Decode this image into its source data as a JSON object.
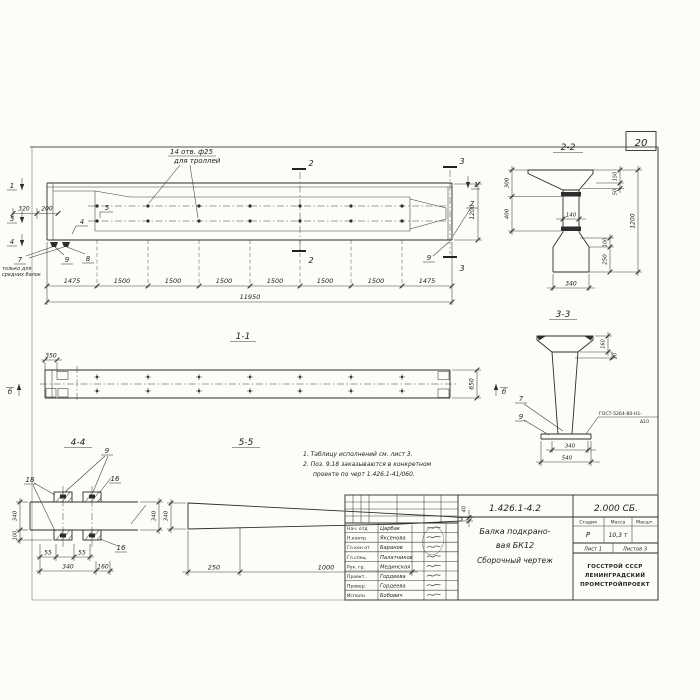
{
  "page": {
    "number": "20"
  },
  "el": {
    "callout1": "14 отв. ф25",
    "callout2": "для троллей",
    "d320": "320",
    "d200": "200",
    "d1200": "1200",
    "p5": "5",
    "p4": "4",
    "p7l": "7",
    "p9l": "9",
    "p8": "8",
    "p7r": "7",
    "p9r": "9",
    "note1": "только для",
    "note2": "средних балок",
    "m1l": "1",
    "m5": "5",
    "m4": "4",
    "m1r": "1",
    "m2": "2",
    "m3": "3",
    "chain": [
      "1475",
      "1500",
      "1500",
      "1500",
      "1500",
      "1500",
      "1500",
      "1475"
    ],
    "total": "11950"
  },
  "s22": {
    "title": "2-2",
    "d300": "300",
    "d400": "400",
    "d140": "140",
    "d150": "150",
    "d50": "50",
    "d1200": "1200",
    "d100": "100",
    "d250": "250",
    "d340": "340"
  },
  "s33": {
    "title": "3-3",
    "d160": "160",
    "d30": "30",
    "d340": "340",
    "d540": "540",
    "p7": "7",
    "p9": "9",
    "weld1": "ГОСТ-5264-80-Н1-",
    "weld2": "Δ10"
  },
  "s11": {
    "title": "1-1",
    "d350": "350",
    "d650": "650",
    "mark": "б"
  },
  "s44": {
    "title": "4-4",
    "p9": "9",
    "p18": "18",
    "p16": "16",
    "p16b": "16",
    "d55a": "55",
    "d55b": "55",
    "d340": "340",
    "d160": "160",
    "dl340": "340",
    "dl100": "100",
    "dr340": "340"
  },
  "s55": {
    "title": "5-5",
    "d340": "340",
    "d40": "40",
    "d250": "250",
    "d1000": "1000"
  },
  "notes": {
    "l1": "1. Таблицу исполнений см. лист 3.",
    "l2": "2. Поз. 9,18 заказываются в конкретном",
    "l3": "проекте по черт 1.426.1-41/060."
  },
  "tb": {
    "doc": "1.426.1-4.2",
    "series": "2.000 СБ.",
    "name1": "Балка подкрано-",
    "name2": "вая БК12",
    "name3": "Сборочный чертеж",
    "h_stage": "Стадия",
    "h_mass": "Масса",
    "h_scale": "Масшт.",
    "stage": "Р",
    "mass": "10,3 т",
    "sheet": "Лист 1",
    "sheets": "Листов 3",
    "org1": "ГОССТРОЙ СССР",
    "org2": "ЛЕНИНГРАДСКИЙ",
    "org3": "ПРОМСТРОЙПРОЕКТ",
    "rows": [
      {
        "r": "Нач. отд",
        "n": "Царбак"
      },
      {
        "r": "Н.контр.",
        "n": "Яксенова"
      },
      {
        "r": "Гл.кон.от",
        "n": "Баранов"
      },
      {
        "r": "Гл.спец.",
        "n": "Палатников"
      },
      {
        "r": "Рук. гр.",
        "n": "Мединская"
      },
      {
        "r": "Проект.",
        "n": "Гордеева"
      },
      {
        "r": "Провер.",
        "n": "Гордеева"
      },
      {
        "r": "Исполн.",
        "n": "Бобович"
      }
    ]
  }
}
